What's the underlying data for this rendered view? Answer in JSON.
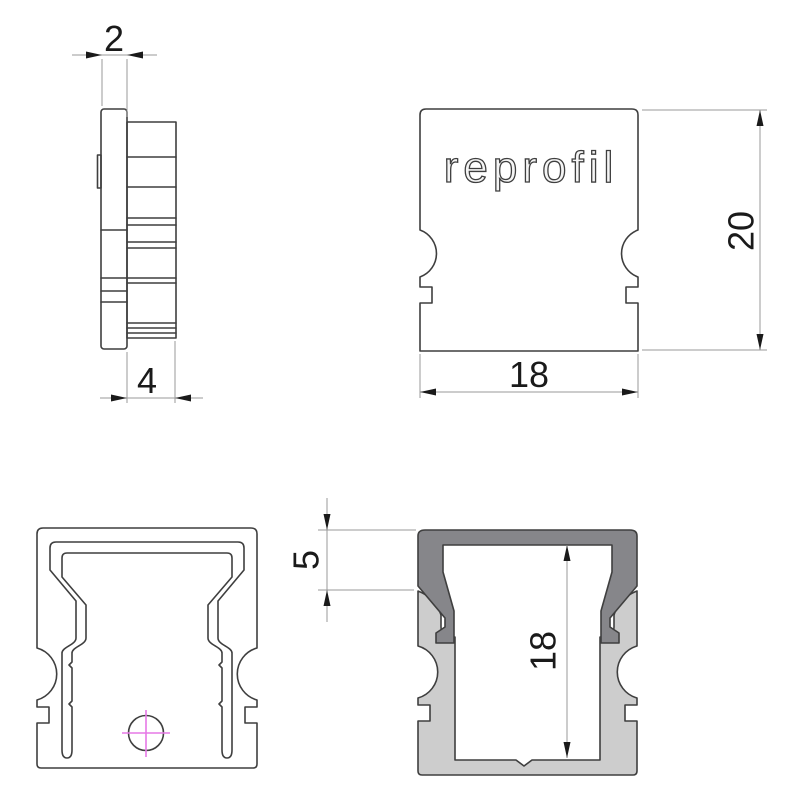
{
  "drawing": {
    "logo_text": "reprofil",
    "dimensions": {
      "cap_thickness": "2",
      "cap_depth": "4",
      "profile_width": "18",
      "profile_height": "20",
      "collar_height": "5",
      "inner_height": "18"
    },
    "colors": {
      "background": "#ffffff",
      "outline": "#3f3f3f",
      "thin_line": "#9a9a9a",
      "dim_text": "#1a1a1a",
      "cap_fill": "#86868a",
      "profile_fill": "#cdcdcd",
      "centerline": "#e678e6"
    }
  }
}
